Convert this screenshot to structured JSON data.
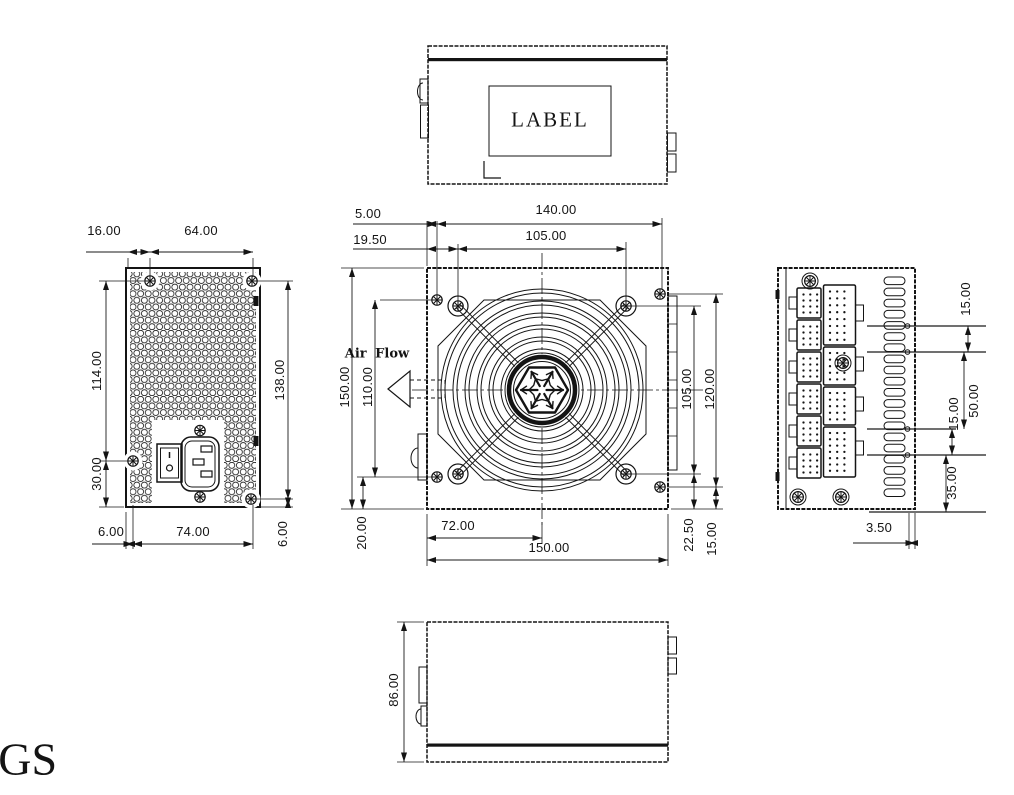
{
  "meta": {
    "background": "#ffffff",
    "ink": "#141414"
  },
  "labels": {
    "model_suffix": "-GS",
    "top_label": "LABEL",
    "air_flow": "Air Flow"
  },
  "dims": {
    "rear": {
      "top_offset": "16.00",
      "screw_span": "64.00",
      "side_upper": "114.00",
      "side_lower": "30.00",
      "height": "138.00",
      "bottom_left": "6.00",
      "bottom_span": "74.00",
      "bottom_right": "6.00"
    },
    "front": {
      "edge_gap": "5.00",
      "screw_span": "140.00",
      "fan_gap": "19.50",
      "fan_span": "105.00",
      "height": "150.00",
      "screw_height": "110.00",
      "fan_height": "105.00",
      "screw_height_right": "120.00",
      "bottom_gap": "20.00",
      "half_width": "72.00",
      "width": "150.00",
      "corner_gap": "22.50",
      "edge_gap_bottom": "15.00"
    },
    "side": {
      "vent_top": "15.00",
      "vent_span": "50.00",
      "vent_mid": "15.00",
      "vent_bottom": "35.00",
      "depth_gap": "3.50"
    },
    "bottom": {
      "height": "86.00"
    }
  }
}
